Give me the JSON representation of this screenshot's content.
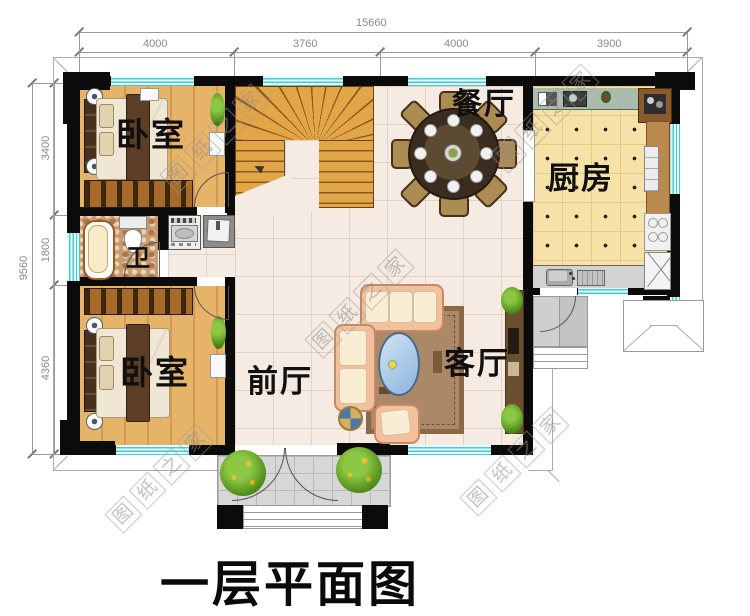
{
  "title": "一层平面图",
  "watermark_chars": [
    "图",
    "纸",
    "之",
    "家"
  ],
  "dimensions": {
    "top": {
      "total": "15660",
      "segments": [
        "4000",
        "3760",
        "4000",
        "3900"
      ]
    },
    "left": {
      "total": "9560",
      "segments": [
        "3400",
        "1800",
        "4360"
      ]
    }
  },
  "rooms": {
    "bedroom_top": "卧室",
    "bedroom_bottom": "卧室",
    "dining": "餐厅",
    "kitchen": "厨房",
    "living": "客厅",
    "foyer": "前厅",
    "bath": "卫"
  },
  "colors": {
    "wall": "#0b0b0b",
    "window": "#49c9d4",
    "wood_floor": "#e6b469",
    "tile_floor": "#f5ebe3",
    "kitchen_floor": "#f6e1a6",
    "stair_wood": "#e2a648"
  }
}
